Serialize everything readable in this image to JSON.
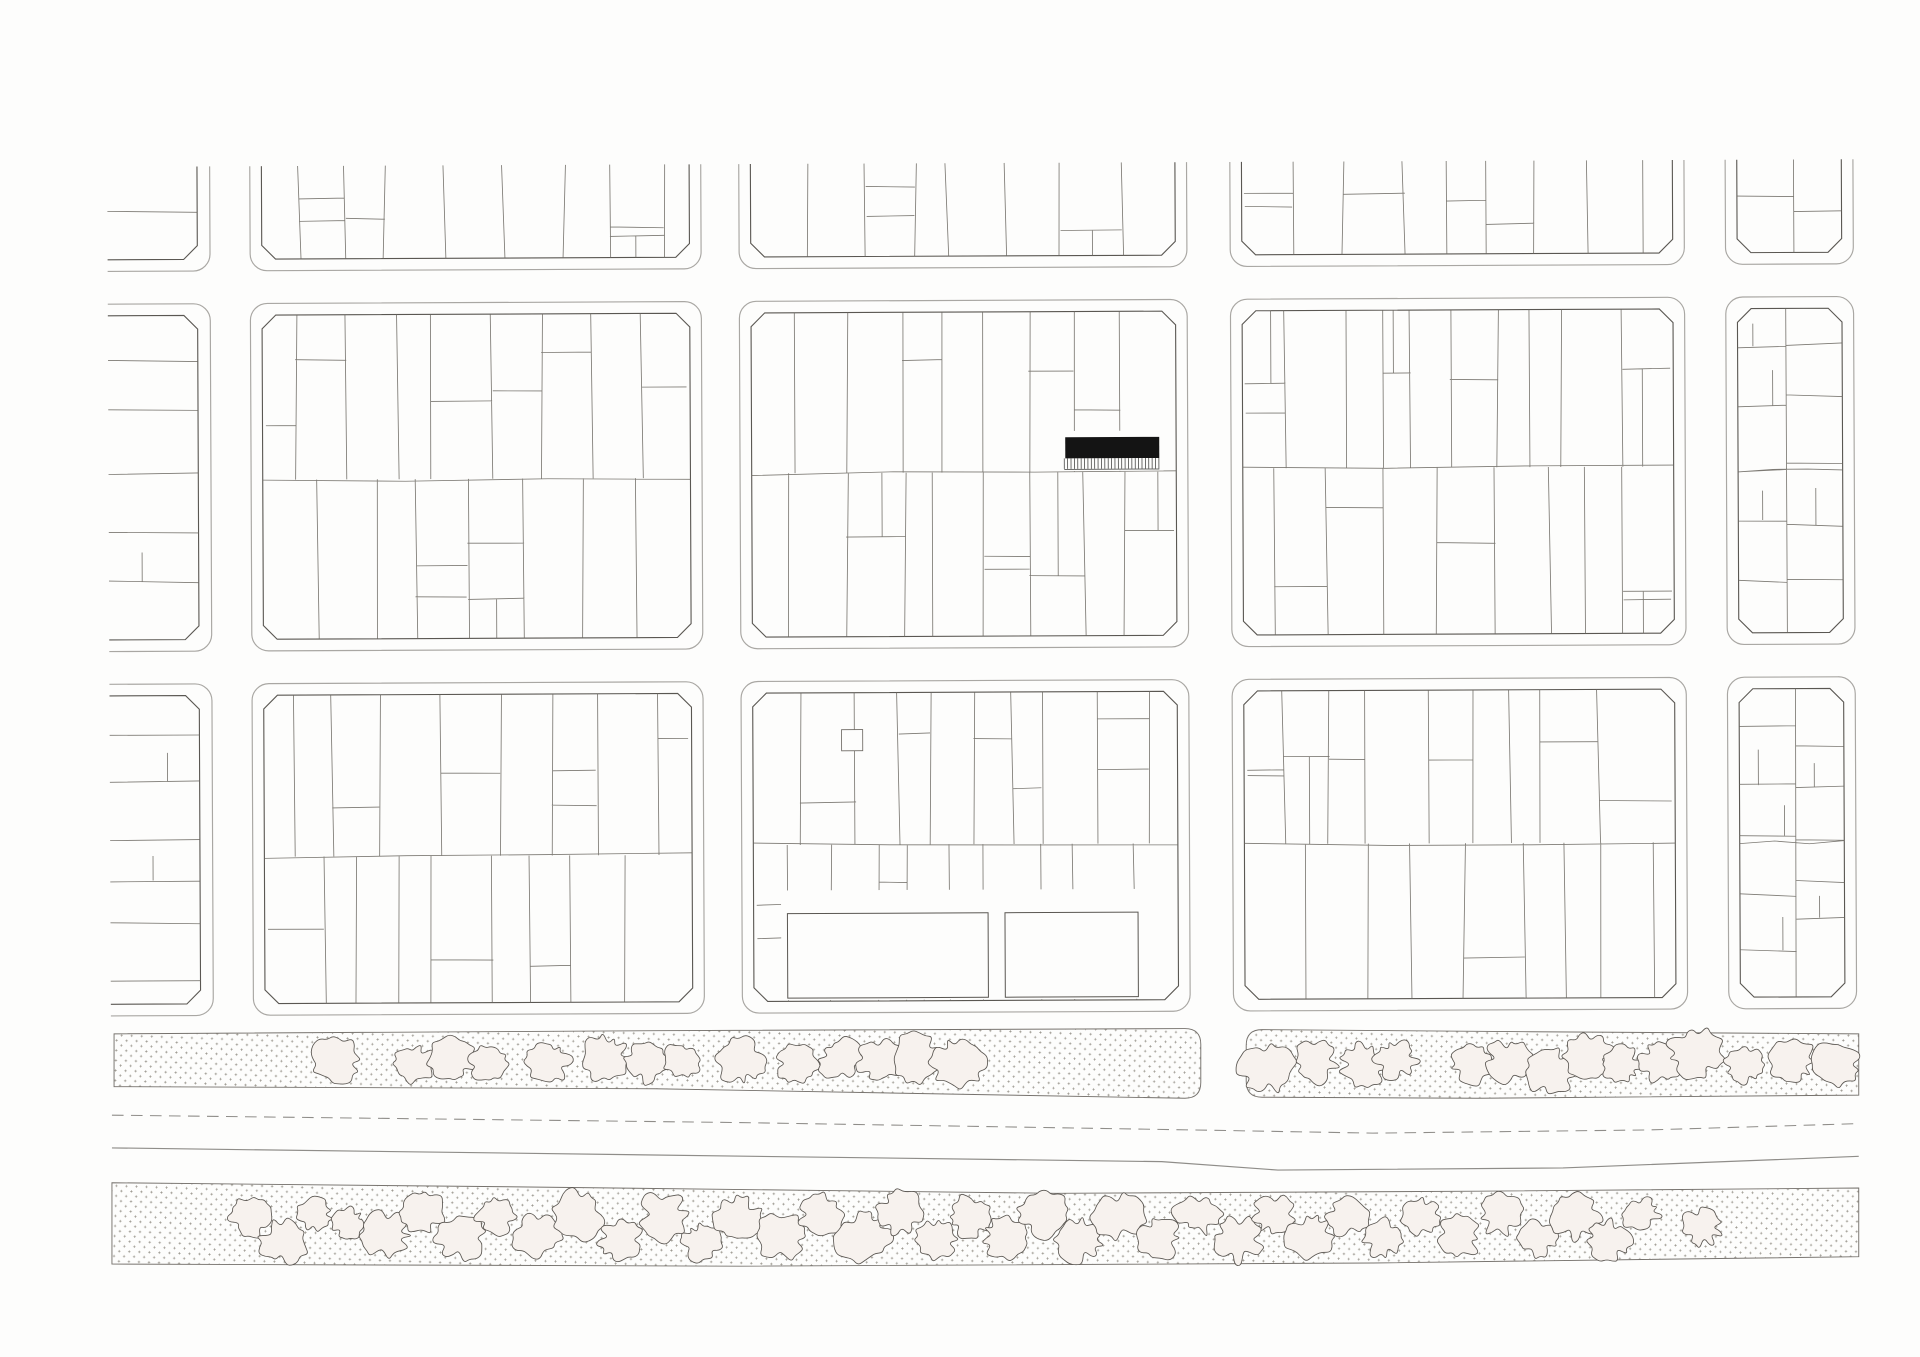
{
  "canvas": {
    "width": 1920,
    "height": 1357,
    "viewbox": "0 0 1818 1285",
    "background": "#fdfdfc"
  },
  "palette": {
    "paper": "#fdfdfc",
    "curb": "#a9a7a3",
    "block_edge": "#5a5752",
    "parcel_line": "#6e6a64",
    "building_fill": "#141414",
    "hatch_line": "#3a3a38",
    "tree_fill": "#f7f2ee",
    "tree_stroke": "#5a5651",
    "stipple_dot": "#8d897f",
    "strip_edge": "#76726d",
    "road_line": "#8f8d89"
  },
  "plan": {
    "rotation": -0.25,
    "content_top": 158,
    "content_left": 105,
    "content_right": 1760,
    "inset": 11,
    "chamfer": 13,
    "corner_radius": 16,
    "cols": {
      "L": {
        "x0": 105,
        "x1": 202,
        "cut_left": true
      },
      "c1": {
        "x0": 240,
        "x1": 667
      },
      "c2": {
        "x0": 703,
        "x1": 1127
      },
      "c3": {
        "x0": 1168,
        "x1": 1598
      },
      "c4": {
        "x0": 1637,
        "x1": 1758
      }
    },
    "rows": {
      "r1": {
        "y0": 158,
        "y1": 257,
        "cut_top": true
      },
      "r2": {
        "y0": 288,
        "y1": 617
      },
      "r3": {
        "y0": 648,
        "y1": 962
      }
    },
    "blocks": [
      {
        "id": "r1-L",
        "col": "L",
        "row": "r1",
        "mode": "sideTop",
        "seed": 20
      },
      {
        "id": "r1-c1",
        "col": "c1",
        "row": "r1",
        "mode": "vTop",
        "seed": 21
      },
      {
        "id": "r1-c2",
        "col": "c2",
        "row": "r1",
        "mode": "vTop",
        "seed": 22
      },
      {
        "id": "r1-c3",
        "col": "c3",
        "row": "r1",
        "mode": "vTop",
        "seed": 23
      },
      {
        "id": "r1-c4",
        "col": "c4",
        "row": "r1",
        "mode": "col4Top",
        "seed": 24
      },
      {
        "id": "r2-L",
        "col": "L",
        "row": "r2",
        "mode": "side",
        "seed": 30
      },
      {
        "id": "r2-c1",
        "col": "c1",
        "row": "r2",
        "mode": "vFull",
        "seed": 31
      },
      {
        "id": "r2-c2",
        "col": "c2",
        "row": "r2",
        "mode": "vFull",
        "seed": 32,
        "special": "building"
      },
      {
        "id": "r2-c3",
        "col": "c3",
        "row": "r2",
        "mode": "vFull",
        "seed": 33
      },
      {
        "id": "r2-c4",
        "col": "c4",
        "row": "r2",
        "mode": "col4",
        "seed": 34
      },
      {
        "id": "r3-L",
        "col": "L",
        "row": "r3",
        "mode": "side",
        "seed": 40
      },
      {
        "id": "r3-c1",
        "col": "c1",
        "row": "r3",
        "mode": "vFull",
        "seed": 41
      },
      {
        "id": "r3-c2",
        "col": "c2",
        "row": "r3",
        "mode": "vFull",
        "seed": 42,
        "special": "plaza"
      },
      {
        "id": "r3-c3",
        "col": "c3",
        "row": "r3",
        "mode": "vFull",
        "seed": 43
      },
      {
        "id": "r3-c4",
        "col": "c4",
        "row": "r3",
        "mode": "col4",
        "seed": 44
      }
    ],
    "highlighted_building": {
      "underlay": [
        1004,
        412,
        100,
        38
      ],
      "rect": [
        1011,
        418,
        89,
        20
      ],
      "hatch_y0": 438,
      "hatch_y1": 448,
      "hatch_x0": 1010,
      "hatch_x1": 1100,
      "hatch_step": 3.2,
      "hatch_base_y": 448.4
    },
    "plaza": {
      "underlay": [
        740,
        846,
        352,
        104
      ],
      "rects": [
        [
          746,
          868,
          190,
          80
        ],
        [
          952,
          868,
          126,
          80
        ]
      ],
      "small_square": [
        798,
        694,
        20,
        20
      ]
    },
    "boulevard": {
      "strip_upper_left_d": "M108,979 L620,976 L1122,974 Q1137,974 1137,989 L1137,1025 Q1137,1040 1122,1040 L620,1031 L108,1029 Z",
      "strip_upper_right_d": "M1195,975 L1450,977 L1760,979 L1760,1037 L1400,1040 L1195,1039 Q1180,1039 1180,1024 L1180,990 Q1180,975 1195,975 Z",
      "strip_lower_d": "M106,1120 L500,1124 L1000,1130 L1400,1128 L1760,1125 L1760,1190 L1300,1196 L700,1199 L106,1197 Z",
      "dashed_centerline_d": "M106,1056 L700,1063 L1130,1070 L1300,1073 L1560,1070 L1760,1064",
      "road_edge_d": "M106,1087 L1100,1100 L1210,1108 L1480,1106 L1760,1095",
      "dash_pattern": "11 7"
    },
    "stipple": {
      "cell": 9.5,
      "mark_half": 1.2,
      "stroke_width": 0.55
    },
    "trees": {
      "upper": [
        [
          318,
          1004,
          26
        ],
        [
          392,
          1007,
          22
        ],
        [
          428,
          1003,
          25
        ],
        [
          462,
          1007,
          20
        ],
        [
          520,
          1005,
          24
        ],
        [
          574,
          1002,
          26
        ],
        [
          612,
          1006,
          24
        ],
        [
          645,
          1004,
          20
        ],
        [
          702,
          1005,
          26
        ],
        [
          754,
          1007,
          23
        ],
        [
          796,
          1003,
          24
        ],
        [
          834,
          1006,
          26
        ],
        [
          868,
          1002,
          28
        ],
        [
          906,
          1006,
          29
        ],
        [
          1200,
          1012,
          29
        ],
        [
          1246,
          1006,
          24
        ],
        [
          1292,
          1008,
          26
        ],
        [
          1322,
          1003,
          23
        ],
        [
          1392,
          1008,
          23
        ],
        [
          1428,
          1005,
          25
        ],
        [
          1468,
          1014,
          27
        ],
        [
          1504,
          1000,
          26
        ],
        [
          1536,
          1008,
          21
        ],
        [
          1572,
          1006,
          23
        ],
        [
          1606,
          997,
          29
        ],
        [
          1652,
          1008,
          21
        ],
        [
          1698,
          1005,
          25
        ],
        [
          1738,
          1008,
          26
        ]
      ],
      "lower": [
        [
          238,
          1152,
          23
        ],
        [
          268,
          1176,
          26
        ],
        [
          298,
          1150,
          19
        ],
        [
          330,
          1158,
          18
        ],
        [
          365,
          1170,
          27
        ],
        [
          400,
          1148,
          24
        ],
        [
          436,
          1172,
          26
        ],
        [
          470,
          1152,
          21
        ],
        [
          508,
          1168,
          26
        ],
        [
          548,
          1150,
          28
        ],
        [
          588,
          1174,
          24
        ],
        [
          628,
          1152,
          28
        ],
        [
          664,
          1176,
          22
        ],
        [
          700,
          1154,
          26
        ],
        [
          740,
          1172,
          28
        ],
        [
          778,
          1150,
          24
        ],
        [
          816,
          1170,
          30
        ],
        [
          852,
          1148,
          26
        ],
        [
          886,
          1174,
          22
        ],
        [
          918,
          1152,
          25
        ],
        [
          952,
          1172,
          24
        ],
        [
          988,
          1150,
          27
        ],
        [
          1022,
          1174,
          26
        ],
        [
          1060,
          1152,
          28
        ],
        [
          1098,
          1172,
          24
        ],
        [
          1134,
          1150,
          26
        ],
        [
          1172,
          1174,
          27
        ],
        [
          1206,
          1150,
          22
        ],
        [
          1240,
          1170,
          26
        ],
        [
          1276,
          1152,
          24
        ],
        [
          1310,
          1172,
          22
        ],
        [
          1345,
          1152,
          21
        ],
        [
          1382,
          1170,
          24
        ],
        [
          1420,
          1150,
          25
        ],
        [
          1456,
          1172,
          22
        ],
        [
          1492,
          1152,
          27
        ],
        [
          1524,
          1174,
          23
        ],
        [
          1554,
          1150,
          20
        ],
        [
          1612,
          1162,
          22
        ]
      ]
    }
  }
}
